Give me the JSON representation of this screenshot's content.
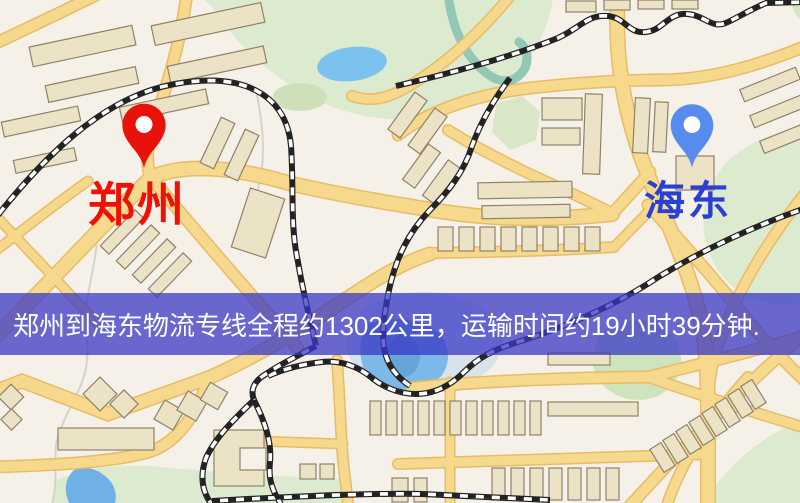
{
  "banner": {
    "text": "郑州到海东物流专线全程约1302公里，运输时间约19小时39分钟.",
    "background_color": "#3a38c6",
    "text_color": "#ffffff"
  },
  "markers": {
    "origin": {
      "label": "郑州",
      "pin_color": "#e8120b",
      "label_color": "#ee1105"
    },
    "destination": {
      "label": "海东",
      "pin_color": "#578cee",
      "label_color": "#2a3fd6"
    }
  },
  "route": {
    "origin": "郑州",
    "destination": "海东",
    "distance_text": "约1302公里",
    "duration_text": "约19小时39分钟"
  },
  "map_colors": {
    "background": "#f5f1e8",
    "road_fill": "#f7d98d",
    "road_casing": "#e6bc66",
    "building_fill": "#ece2c6",
    "building_stroke": "#8f8268",
    "green_area": "#dcead0",
    "water": "#7cc2ee",
    "railway": "#222222"
  }
}
